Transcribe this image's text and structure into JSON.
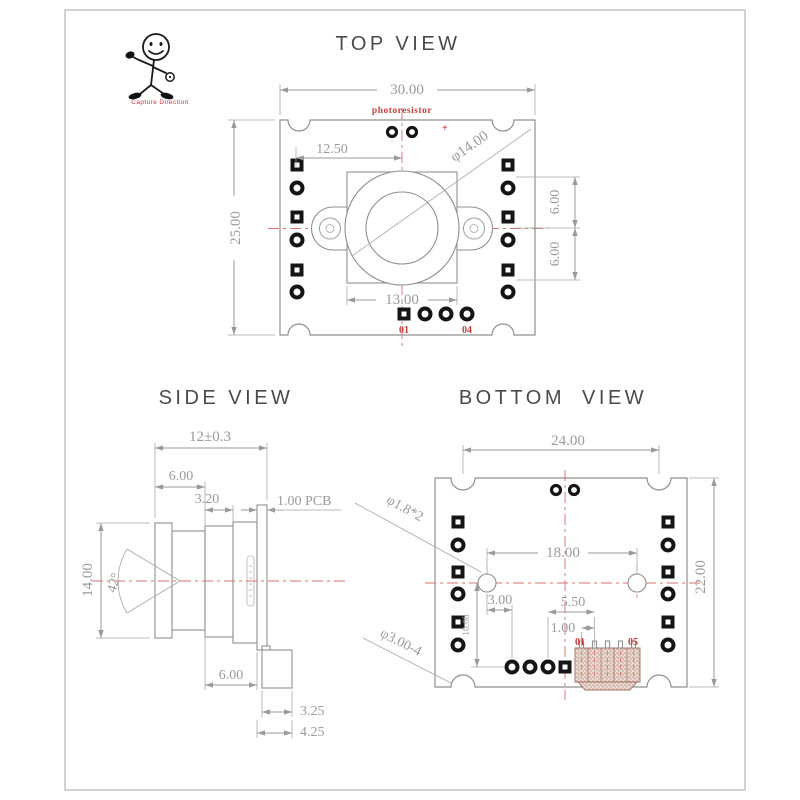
{
  "logo": {
    "caption": "Capture Direction"
  },
  "top_view": {
    "title": "TOP VIEW",
    "component_label": "photoresistor",
    "polarity_mark": "+",
    "dims": {
      "board_width": "30.00",
      "board_height": "25.00",
      "hole_offset": "12.50",
      "lens_diameter": "φ14.00",
      "holder_width": "13.00",
      "pad_pitch_upper": "6.00",
      "pad_pitch_lower": "6.00"
    },
    "pins": {
      "first": "01",
      "last": "04"
    }
  },
  "side_view": {
    "title": "SIDE VIEW",
    "dims": {
      "total_depth": "12±0.3",
      "lens_front": "6.00",
      "barrel": "3.20",
      "pcb_thickness": "1.00 PCB",
      "lens_diameter": "14.00",
      "fov_angle": "42°",
      "holder_depth": "6.00",
      "connector_depth": "3.25",
      "connector_total": "4.25"
    }
  },
  "bottom_view": {
    "title": "BOTTOM VIEW",
    "dims": {
      "board_width": "24.00",
      "board_height": "22.00",
      "hole_pitch": "18.00",
      "hole_offset_x": "3.00",
      "connector_offset": "5.50",
      "pin_pitch": "1.00",
      "pad_offset": "10.08",
      "small_hole": "φ1.8*2",
      "corner_notch": "φ3.00-4"
    },
    "pins": {
      "first": "01",
      "last": "05"
    }
  }
}
